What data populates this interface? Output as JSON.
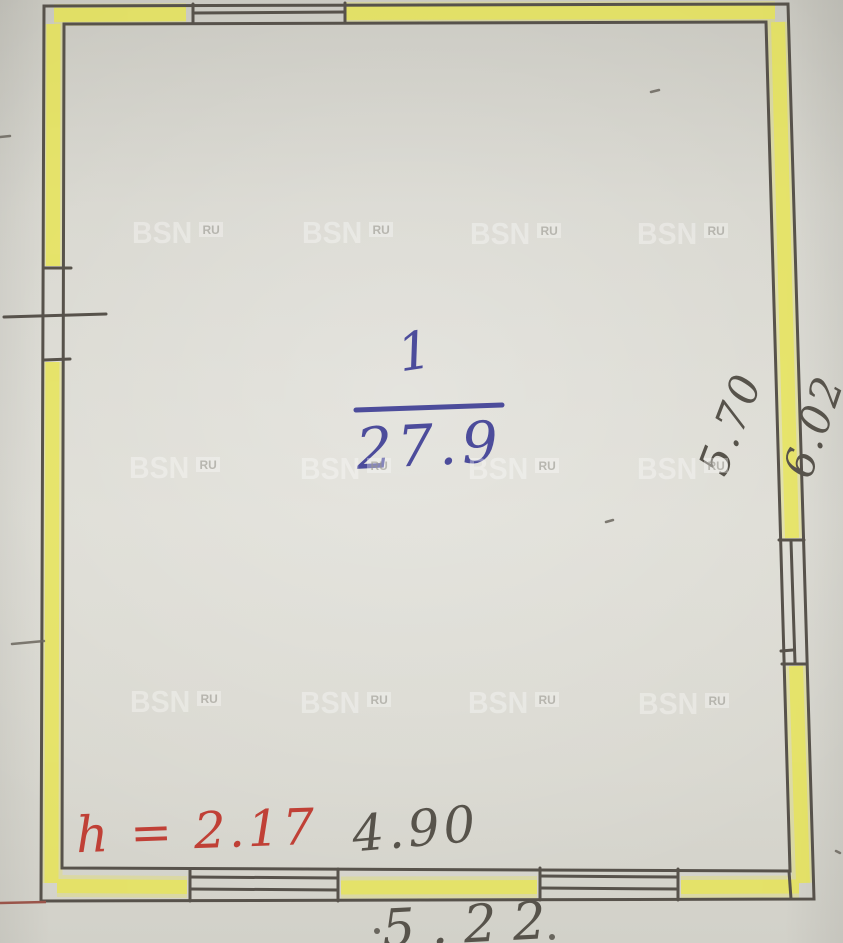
{
  "document": {
    "type": "scanned floor plan sheet"
  },
  "watermark": {
    "text": "BSN",
    "badge": "RU"
  },
  "room": {
    "number": "1",
    "area": "27.9"
  },
  "annotations": {
    "ceiling_height": "h = 2.17",
    "width_inner": "4.90",
    "width_outer": "5.22",
    "depth_inner": "5.70",
    "depth_outer": "6.02"
  },
  "colors": {
    "ink_blue": "#4c4c9b",
    "ink_red": "#c04036",
    "pencil": "#57534b",
    "wall_line": "#57524b",
    "wall_highlight": "#e9e64c",
    "paper": "#d7d6ce"
  }
}
